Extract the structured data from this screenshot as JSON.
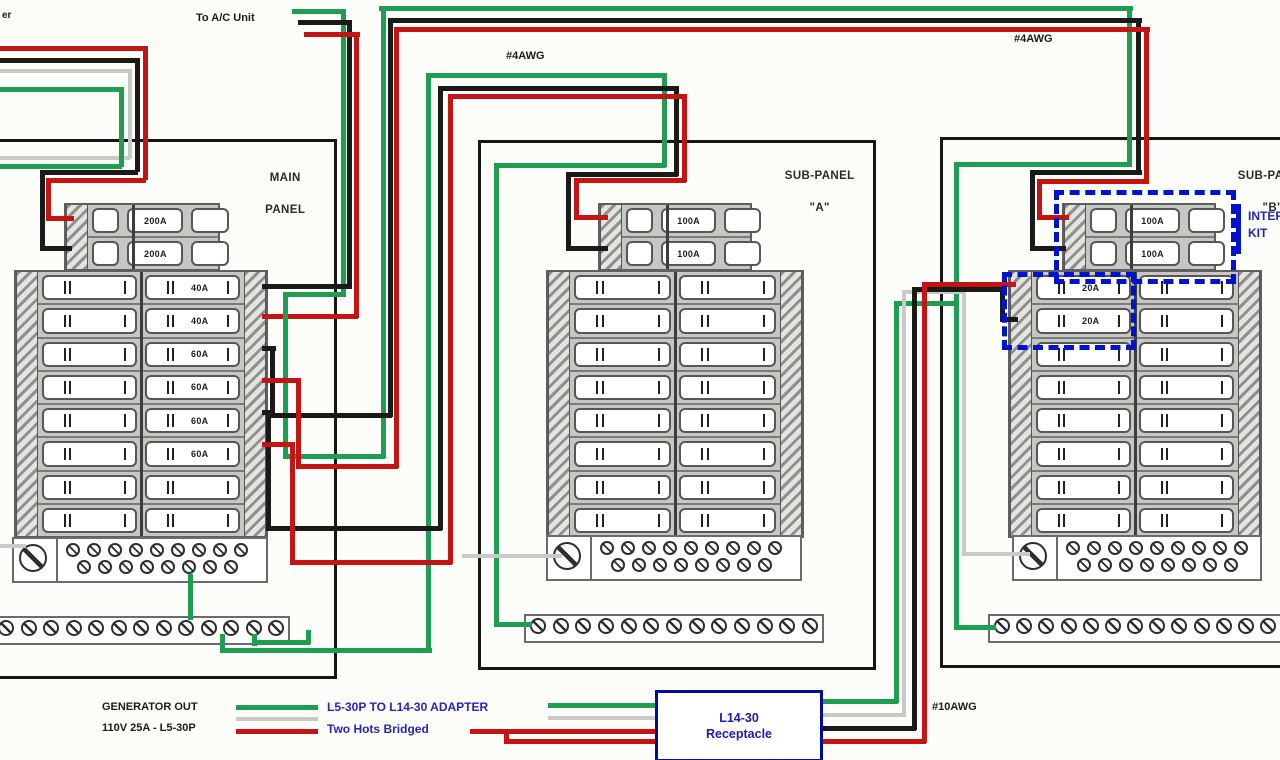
{
  "labels": {
    "meter_fragment": "er",
    "ac_unit": "To A/C Unit",
    "feeder_a_gauge": "#4AWG",
    "feeder_b_gauge": "#4AWG",
    "generator_gauge": "#10AWG"
  },
  "panels": {
    "main": {
      "name_lines": [
        "MAIN",
        "PANEL"
      ],
      "main_breaker_poles": [
        "200A",
        "200A"
      ],
      "branch_labels_left": [
        "",
        "",
        "",
        "",
        "",
        "",
        "",
        ""
      ],
      "branch_labels_right": [
        "40A",
        "40A",
        "60A",
        "60A",
        "60A",
        "60A",
        "",
        ""
      ]
    },
    "sub_a": {
      "name_lines": [
        "SUB-PANEL",
        "\"A\""
      ],
      "main_breaker_poles": [
        "100A",
        "100A"
      ],
      "branch_labels_left": [
        "",
        "",
        "",
        "",
        "",
        "",
        "",
        ""
      ],
      "branch_labels_right": [
        "",
        "",
        "",
        "",
        "",
        "",
        "",
        ""
      ]
    },
    "sub_b": {
      "name_lines": [
        "SUB-PANEL",
        "\"B\""
      ],
      "main_breaker_poles": [
        "100A",
        "100A"
      ],
      "branch_labels_left": [
        "20A",
        "20A",
        "",
        "",
        "",
        "",
        "",
        ""
      ],
      "branch_labels_right": [
        "",
        "",
        "",
        "",
        "",
        "",
        "",
        ""
      ]
    }
  },
  "interlock_kit": {
    "label_lines": [
      "INTERLOCK",
      "KIT"
    ],
    "color": "#0013cc"
  },
  "receptacle": {
    "lines": [
      "L14-30",
      "Receptacle"
    ],
    "border_color": "#000d9b",
    "text_color": "#1b1bb0"
  },
  "legend": {
    "generator": {
      "line1": "GENERATOR OUT",
      "line2": "110V 25A - L5-30P"
    },
    "adapter": {
      "line1": "L5-30P TO L14-30 ADAPTER",
      "line2": "Two Hots Bridged"
    },
    "adapter_text_color": "#2626b8"
  },
  "wire_colors": {
    "black": "#1a1a1a",
    "red": "#c41414",
    "green": "#1f9d53",
    "white": "#c9c9c9"
  }
}
